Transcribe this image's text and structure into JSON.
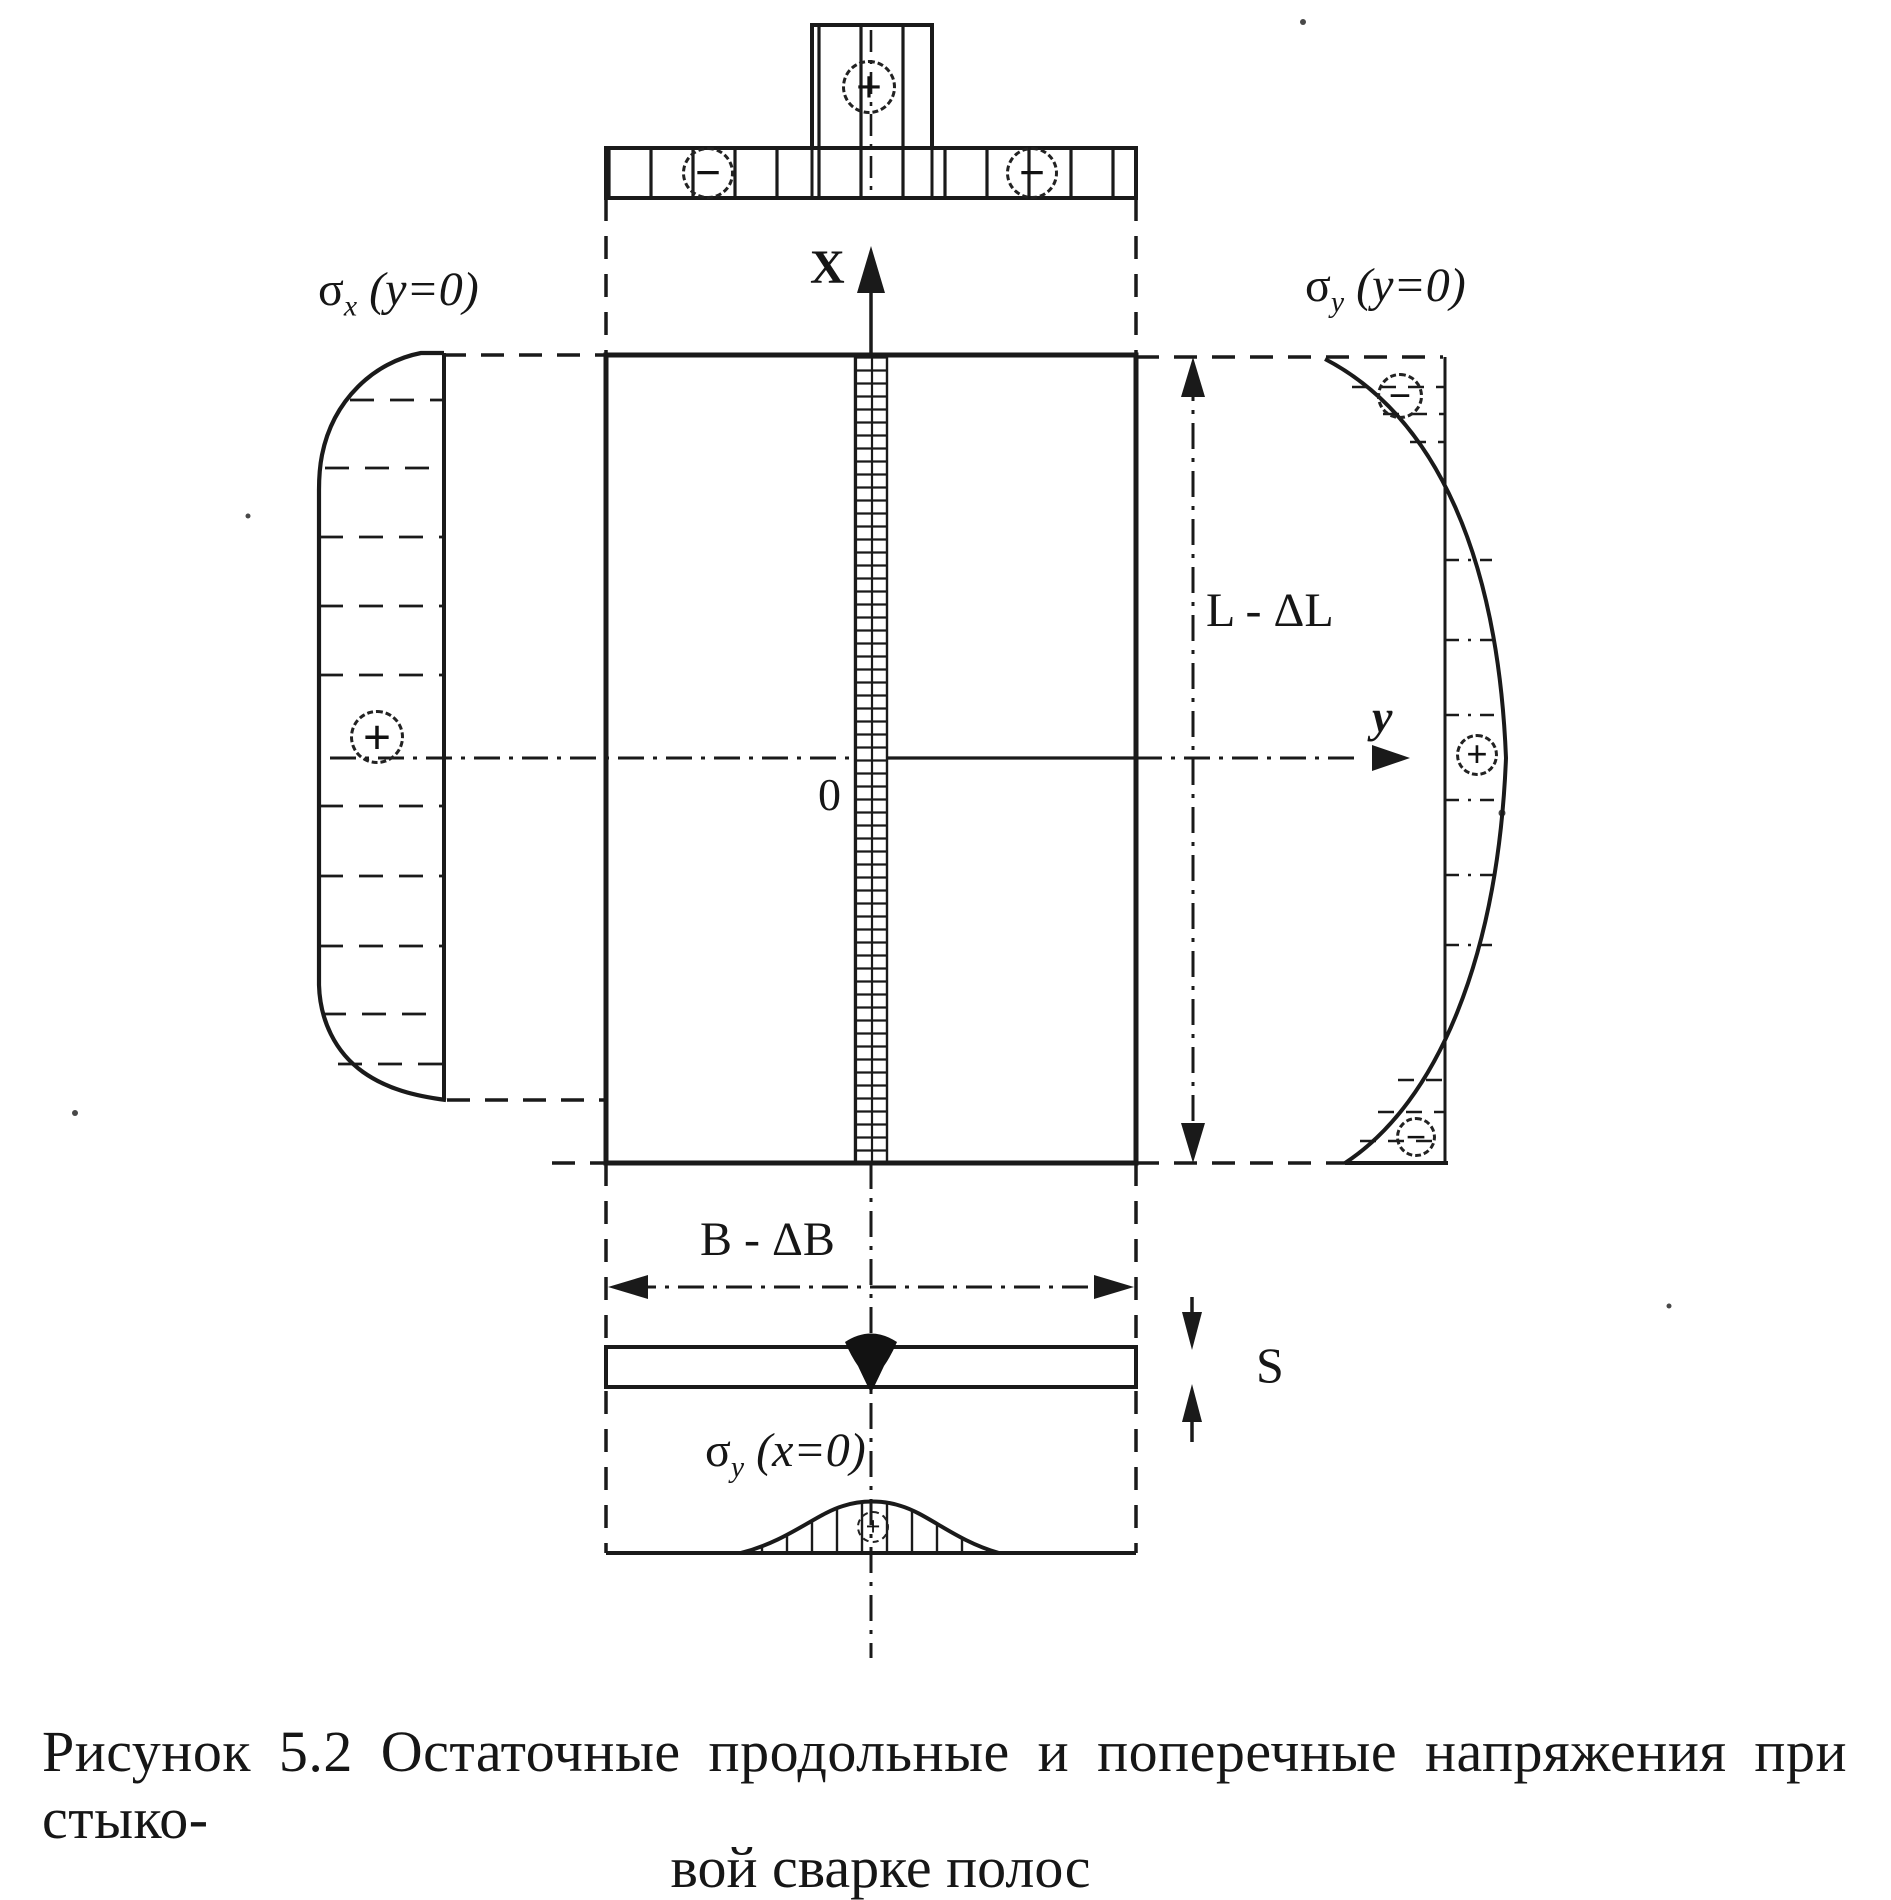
{
  "figure_caption": {
    "line1": "Рисунок 5.2 Остаточные продольные и поперечные напряжения при стыко-",
    "line2": "вой сварке полос"
  },
  "axes": {
    "x": "X",
    "y": "y",
    "origin": "0"
  },
  "dimensions": {
    "length": "L - ΔL",
    "width": "B - ΔB",
    "thickness": "S"
  },
  "stress_labels": {
    "sigma": "σ",
    "left_profile": {
      "sub": "x",
      "condition": "(y=0)"
    },
    "right_profile": {
      "sub": "y",
      "condition": "(y=0)"
    },
    "bottom_profile": {
      "sub": "y",
      "condition": "(x=0)"
    }
  },
  "signs": {
    "plus": "+",
    "minus": "−"
  },
  "colors": {
    "ink": "#1a1a1a",
    "paper": "#ffffff"
  }
}
